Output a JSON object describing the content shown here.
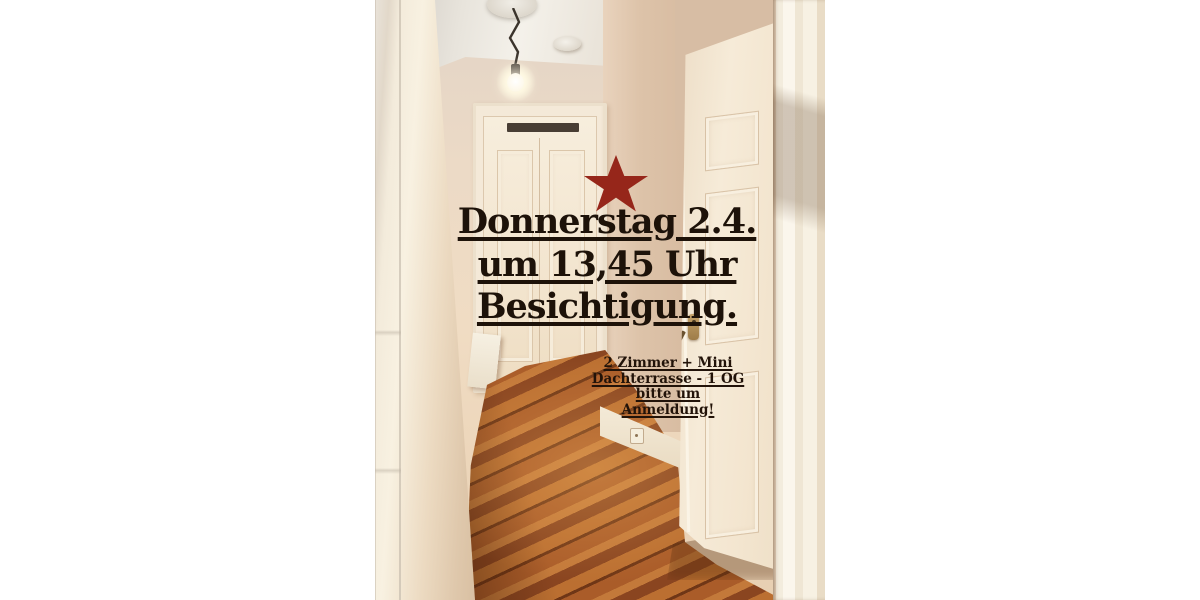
{
  "page": {
    "background_color": "#ffffff"
  },
  "flyer": {
    "star_color": "#96261a",
    "text_color": "#1d1209",
    "headline": {
      "lines": [
        "Donnerstag 2.4.",
        "um 13,45 Uhr",
        "Besichtigung."
      ]
    },
    "details": {
      "lines": [
        "2 Zimmer + Mini",
        "Dachterrasse - 1 OG",
        "bitte um",
        "Anmeldung!"
      ]
    }
  },
  "photo": {
    "colors": {
      "wall": "#eedcc6",
      "shadow_wall": "#d7bda4",
      "door_white": "#f5ead8",
      "floor_light": "#c3793a",
      "floor_mid": "#aa5c29",
      "floor_dark": "#8a4520"
    }
  }
}
